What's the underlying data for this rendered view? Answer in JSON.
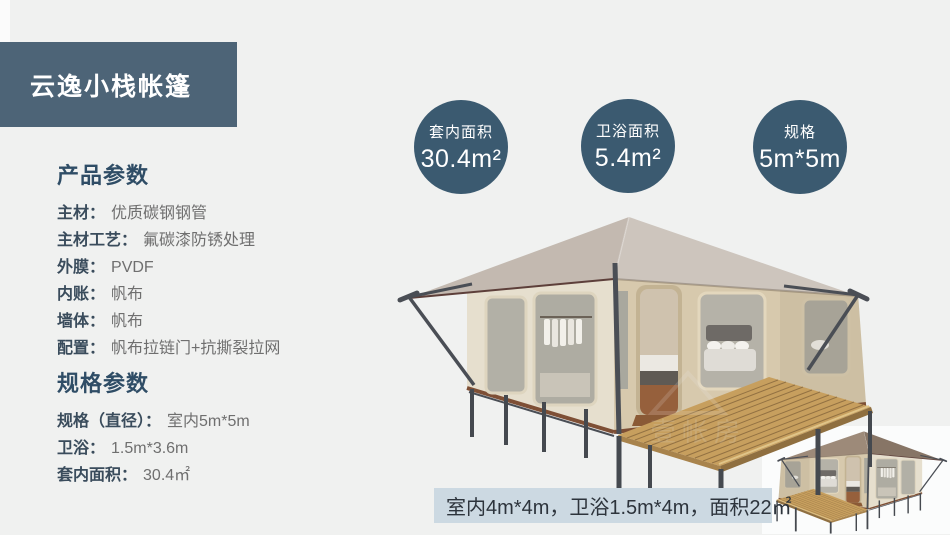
{
  "banner": {
    "title": "云逸小栈帐篷"
  },
  "product_params": {
    "heading": "产品参数",
    "rows": [
      {
        "label": "主材：",
        "value": "优质碳钢钢管"
      },
      {
        "label": "主材工艺：",
        "value": "氟碳漆防锈处理"
      },
      {
        "label": "外膜：",
        "value": "PVDF"
      },
      {
        "label": "内账：",
        "value": "帆布"
      },
      {
        "label": "墙体：",
        "value": "帆布"
      },
      {
        "label": "配置：",
        "value": "帆布拉链门+抗撕裂拉网"
      }
    ]
  },
  "spec_params": {
    "heading": "规格参数",
    "rows": [
      {
        "label": "规格（直径）：",
        "value": "室内5m*5m"
      },
      {
        "label": "卫浴：",
        "value": "1.5m*3.6m"
      },
      {
        "label": "套内面积：",
        "value": "30.4㎡"
      }
    ]
  },
  "badges": [
    {
      "label": "套内面积",
      "value": "30.4m²"
    },
    {
      "label": "卫浴面积",
      "value": "5.4m²"
    },
    {
      "label": "规格",
      "value": "5m*5m"
    }
  ],
  "caption": {
    "text": "室内4m*4m，卫浴1.5m*4m，面积22㎡"
  },
  "colors": {
    "accent_circle": "#3b5a70",
    "banner_bg": "#4d6477",
    "caption_bg": "#ccd9e2",
    "page_bg": "#f0f1f0",
    "heading_text": "#2f4d66",
    "roof": "#c9c0b8",
    "wall": "#d7c9ad",
    "deck": "#c79f5e"
  }
}
